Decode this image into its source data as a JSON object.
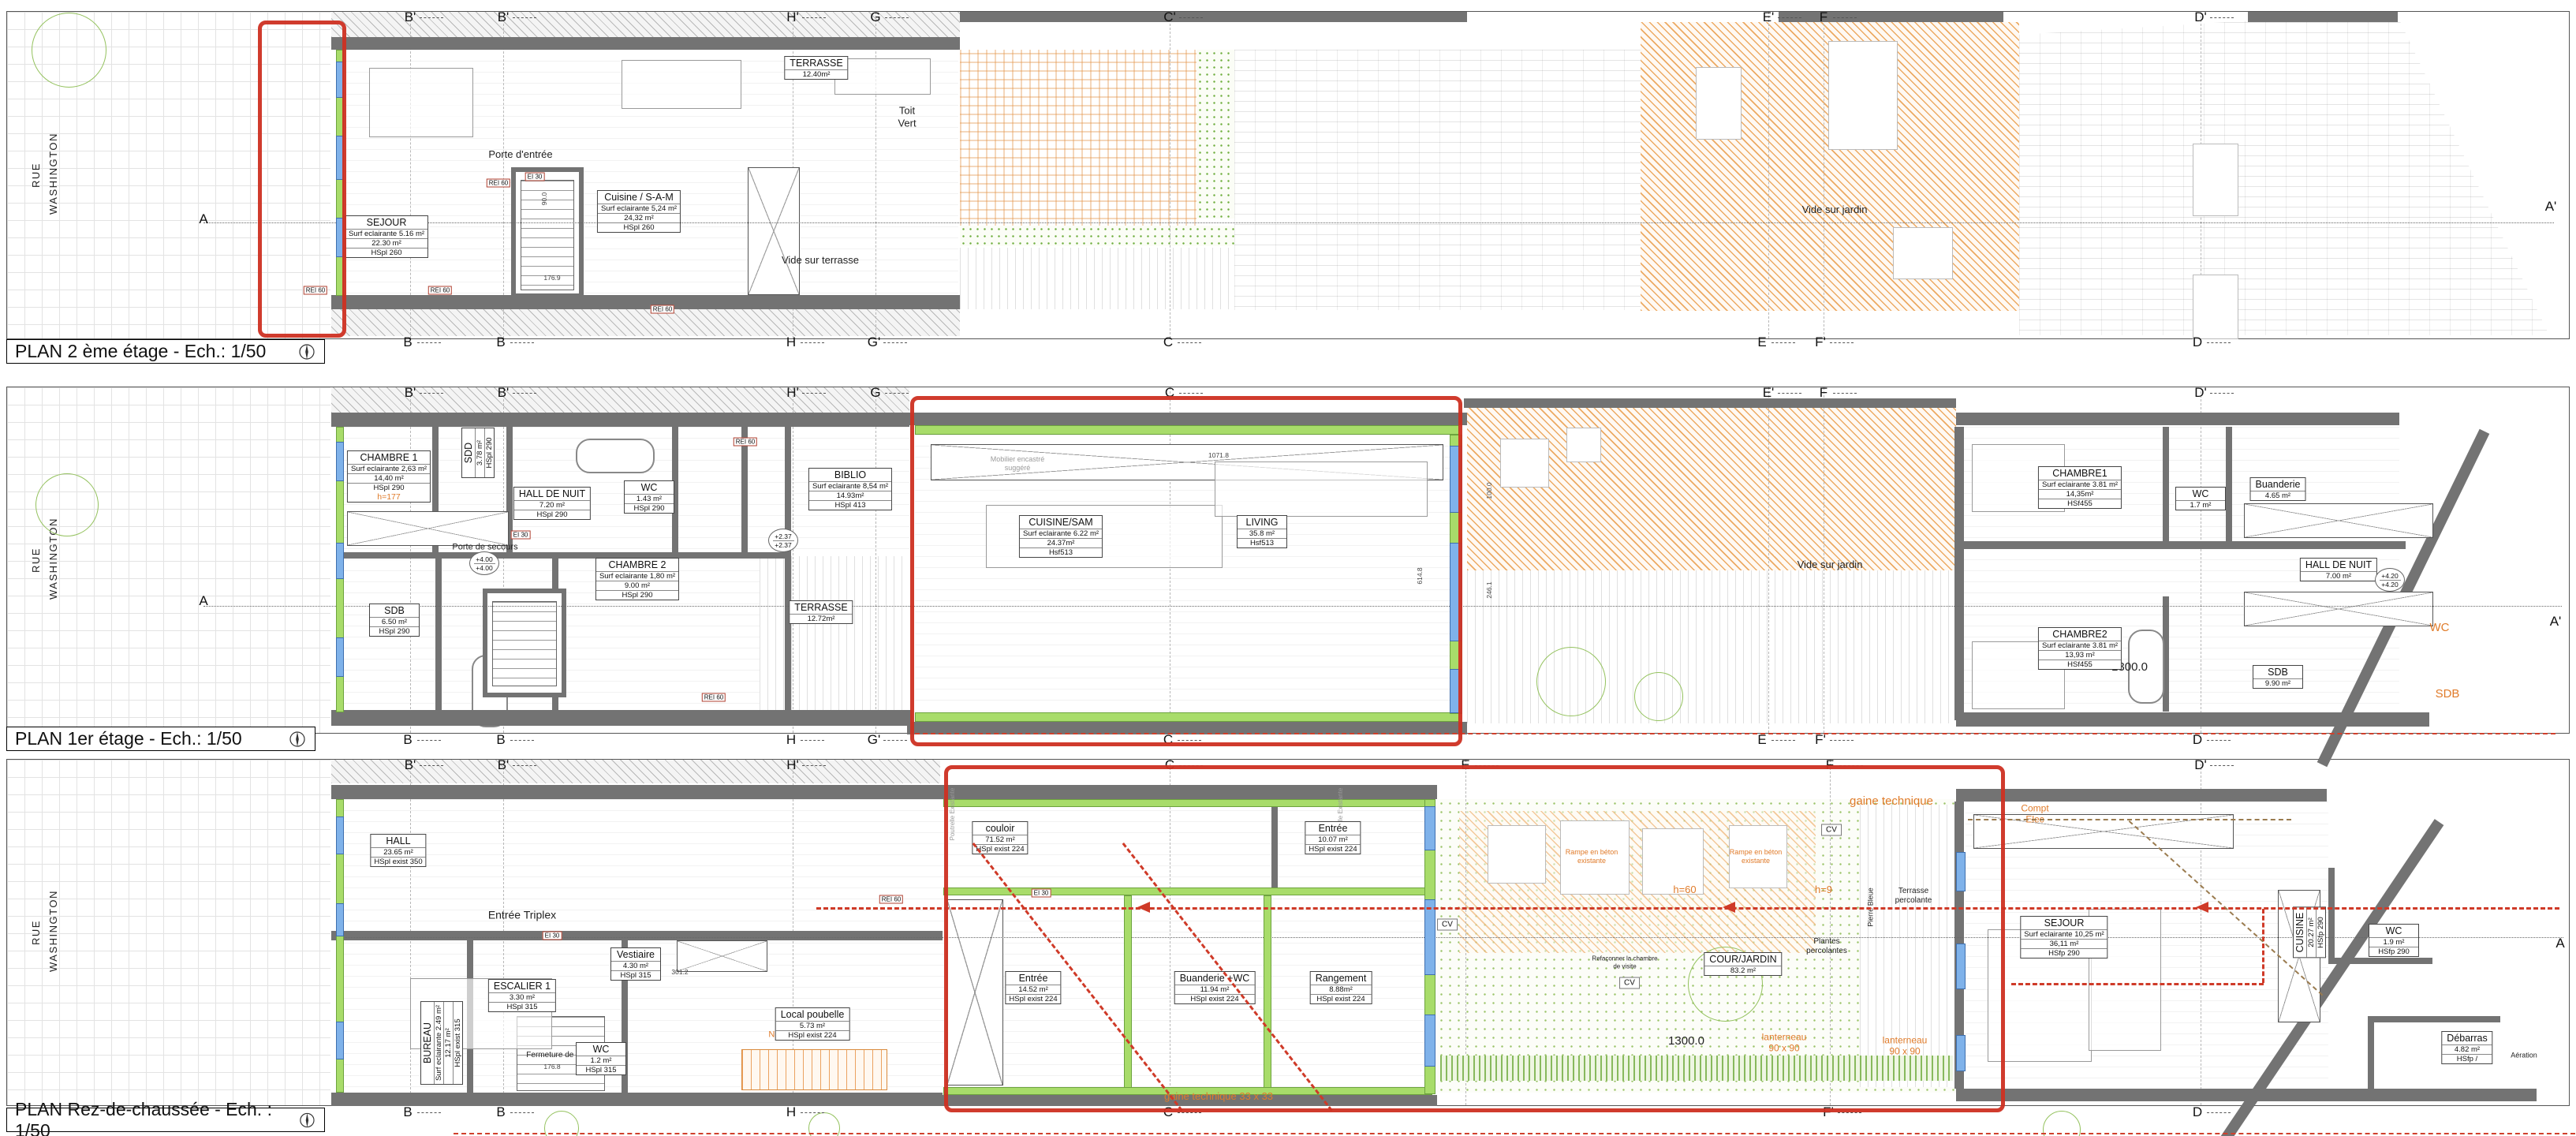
{
  "sheet": {
    "kind": "architectural floor plans",
    "scale": "1/50"
  },
  "colors": {
    "wall": "#737373",
    "insulation_green": "#a8dc6a",
    "window_blue": "#7fb2ea",
    "highlight_red": "#ce3022",
    "demolition_orange": "#e8963f",
    "landscape_green": "#94c25e"
  },
  "floors": [
    {
      "id": "2eme-etage",
      "title": "PLAN 2 ème étage - Ech.: 1/50",
      "street": "RUE WASHINGTON",
      "rooms": [
        {
          "name": "SEJOUR",
          "lines": [
            "Surf eclairante 5.16 m²",
            "22.30 m²",
            "HSpl 260"
          ]
        },
        {
          "name": "Cuisine / S-A-M",
          "lines": [
            "Surf eclairante 5,24 m²",
            "24,32 m²",
            "HSpl 260"
          ]
        },
        {
          "name": "TERRASSE",
          "lines": [
            "12.40m²"
          ]
        }
      ],
      "texts": [
        "Porte d'entrée",
        "Toit Vert",
        "Vide sur terrasse",
        "Vide sur jardin"
      ],
      "tags": [
        "REI 60",
        "REI 60",
        "REI 60",
        "REI 60",
        "EI 30"
      ],
      "dims": [
        "176.9",
        "90.0"
      ],
      "markers_top": [
        "B'",
        "B'",
        "H'",
        "G",
        "C'",
        "E'",
        "F",
        "D'"
      ],
      "markers_bottom": [
        "B",
        "B",
        "H",
        "G'",
        "C",
        "E",
        "F'",
        "D"
      ],
      "markers_side": [
        "A",
        "A'"
      ]
    },
    {
      "id": "1er-etage",
      "title": "PLAN 1er étage - Ech.: 1/50",
      "street": "RUE WASHINGTON",
      "rooms": [
        {
          "name": "CHAMBRE 1",
          "lines": [
            "Surf eclairante 2,63 m²",
            "14,40 m²",
            "HSpl 290"
          ],
          "note": "h=177"
        },
        {
          "name": "SDD",
          "lines": [
            "3.78 m²",
            "HSpl 290"
          ]
        },
        {
          "name": "HALL DE NUIT",
          "lines": [
            "7.20 m²",
            "HSpl 290"
          ]
        },
        {
          "name": "WC",
          "lines": [
            "1.43 m²",
            "HSpl 290"
          ]
        },
        {
          "name": "BIBLIO",
          "lines": [
            "Surf eclairante 8,54 m²",
            "14.93m²",
            "HSpl 413"
          ]
        },
        {
          "name": "CHAMBRE 2",
          "lines": [
            "Surf eclairante 1,80 m²",
            "9.00 m²",
            "HSpl 290"
          ]
        },
        {
          "name": "SDB",
          "lines": [
            "6.50 m²",
            "HSpl 290"
          ]
        },
        {
          "name": "TERRASSE",
          "lines": [
            "12.72m²"
          ]
        },
        {
          "name": "CUISINE/SAM",
          "lines": [
            "Surf eclairante 6.22 m²",
            "24.37m²",
            "Hsf513"
          ]
        },
        {
          "name": "LIVING",
          "lines": [
            "35.8 m²",
            "Hsf513"
          ]
        },
        {
          "name": "CHAMBRE1",
          "lines": [
            "Surf eclairante 3.81 m²",
            "14,35m²",
            "HSf455"
          ]
        },
        {
          "name": "WC",
          "lines": [
            "1.7 m²"
          ]
        },
        {
          "name": "Buanderie",
          "lines": [
            "4.65 m²"
          ]
        },
        {
          "name": "HALL DE NUIT",
          "lines": [
            "7.00 m²"
          ]
        },
        {
          "name": "CHAMBRE2",
          "lines": [
            "Surf eclairante 3.81 m²",
            "13,93 m²",
            "HSf455"
          ]
        },
        {
          "name": "SDB",
          "lines": [
            "9.90 m²"
          ]
        }
      ],
      "texts": [
        "Porte de secours",
        "Vide sur jardin",
        "1300.0",
        "Mobilier encastré suggéré",
        "WC",
        "SDB"
      ],
      "tags": [
        "REI 60",
        "REI 60",
        "EI 30"
      ],
      "elevs": [
        "+4.00",
        "+2.37",
        "+4.20"
      ],
      "dims": [
        "1071.8",
        "614.8",
        "246.1",
        "100.0"
      ],
      "markers_top": [
        "B'",
        "B'",
        "H'",
        "G",
        "C",
        "E'",
        "F",
        "D'"
      ],
      "markers_bottom": [
        "B",
        "B",
        "H",
        "G'",
        "C",
        "E",
        "F'",
        "D"
      ],
      "markers_side": [
        "A",
        "A'"
      ]
    },
    {
      "id": "rez-de-chaussee",
      "title": "PLAN Rez-de-chaussée - Ech. : 1/50",
      "street": "RUE WASHINGTON",
      "rooms": [
        {
          "name": "HALL",
          "lines": [
            "23.65 m²",
            "HSpl exist 350"
          ]
        },
        {
          "name": "ESCALIER 1",
          "lines": [
            "3.30 m²",
            "HSpl 315"
          ]
        },
        {
          "name": "BUREAU",
          "lines": [
            "Surf eclairante 2.49 m²",
            "12.17 m²",
            "HSpl exist 315"
          ]
        },
        {
          "name": "Vestiaire",
          "lines": [
            "4.30 m²",
            "HSpl 315"
          ]
        },
        {
          "name": "WC",
          "lines": [
            "1.2 m²",
            "HSpl 315"
          ]
        },
        {
          "name": "Local poubelle",
          "lines": [
            "5.73 m²",
            "HSpl exist 224"
          ]
        },
        {
          "name": "couloir",
          "lines": [
            "71.52 m²",
            "HSpl exist 224"
          ]
        },
        {
          "name": "Entrée",
          "lines": [
            "10.07 m²",
            "HSpl exist 224"
          ]
        },
        {
          "name": "Entrée",
          "lines": [
            "14.52 m²",
            "HSpl exist 224"
          ]
        },
        {
          "name": "Buanderie +WC",
          "lines": [
            "11.94 m²",
            "HSpl exist 224"
          ]
        },
        {
          "name": "Rangement",
          "lines": [
            "8.88m²",
            "HSpl exist 224"
          ]
        },
        {
          "name": "COUR/JARDIN",
          "lines": [
            "83.2 m²"
          ]
        },
        {
          "name": "SEJOUR",
          "lines": [
            "Surf eclairante 10,25 m²",
            "36,11 m²",
            "HSfp 290"
          ]
        },
        {
          "name": "CUISINE",
          "lines": [
            "20.27 m²",
            "HSfp 290"
          ]
        },
        {
          "name": "WC",
          "lines": [
            "1.9 m²",
            "HSfp 290"
          ]
        },
        {
          "name": "Débarras",
          "lines": [
            "4.82 m²",
            "HSfp /"
          ]
        }
      ],
      "texts": [
        "Entrée Triplex",
        "Fermeture de l'escalier",
        "Nouvel escalier",
        "gaine technique 33 x 33",
        "gaine technique",
        "Rampe en béton existante",
        "Rampe en béton existante",
        "h=60",
        "h=9",
        "Refaçonner la chambre de visite",
        "Plantes percolantes",
        "Terrasse percolante",
        "Pierre Bleue",
        "lanterneau 90 x 90",
        "lanterneau 90 x 90",
        "1300.0",
        "Compt Elec",
        "Aération",
        "Poutrelle Existante",
        "Poutrelle Existante"
      ],
      "cvs": [
        "CV",
        "CV",
        "CV"
      ],
      "tags": [
        "REI 60",
        "EI 30",
        "EI 30"
      ],
      "dims": [
        "438.3",
        "301.2",
        "176.8"
      ],
      "markers_top": [
        "B'",
        "B'",
        "H'",
        "C",
        "E",
        "F",
        "D'"
      ],
      "markers_bottom": [
        "B",
        "B",
        "H",
        "C",
        "F'",
        "D"
      ],
      "markers_side": [
        "A"
      ]
    }
  ]
}
